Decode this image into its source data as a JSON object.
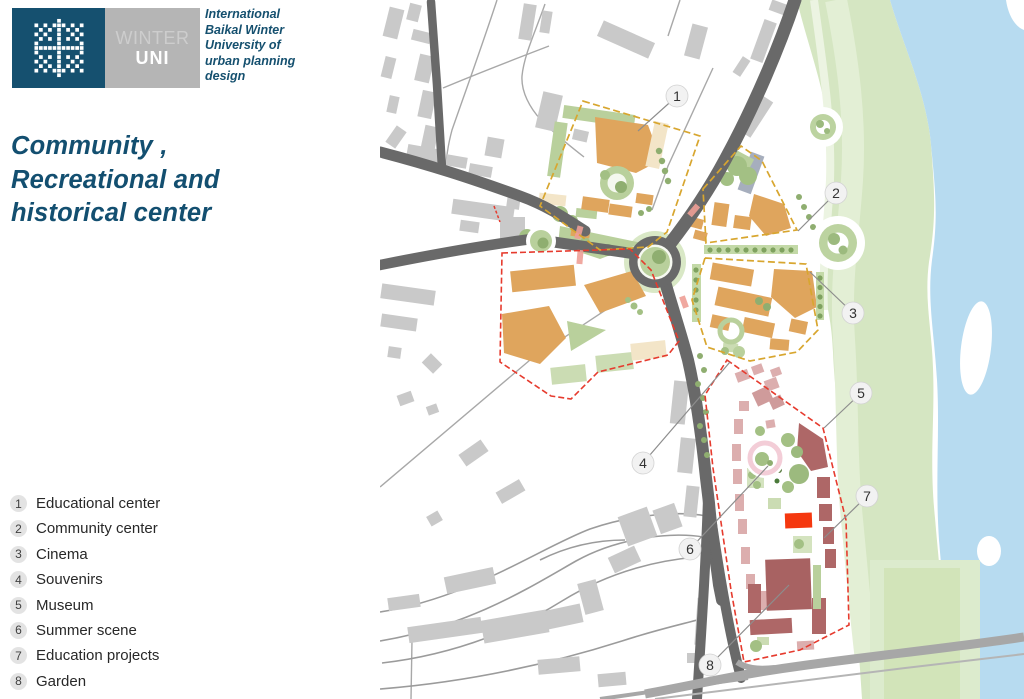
{
  "brand": {
    "winter": "WINTER",
    "uni": "UNI",
    "university_lines": [
      "International",
      "Baikal Winter",
      "University of",
      "urban planning",
      "design"
    ]
  },
  "title_lines": [
    "Community ,",
    "Recreational and",
    "historical center"
  ],
  "legend": [
    {
      "num": "1",
      "label": "Educational center"
    },
    {
      "num": "2",
      "label": "Community center"
    },
    {
      "num": "3",
      "label": "Cinema"
    },
    {
      "num": "4",
      "label": "Souvenirs"
    },
    {
      "num": "5",
      "label": "Museum"
    },
    {
      "num": "6",
      "label": "Summer scene"
    },
    {
      "num": "7",
      "label": "Education projects"
    },
    {
      "num": "8",
      "label": "Garden"
    }
  ],
  "map": {
    "callouts": [
      {
        "num": "1",
        "cx": 677,
        "cy": 96,
        "lx": 638,
        "ly": 131
      },
      {
        "num": "2",
        "cx": 836,
        "cy": 193,
        "lx": 798,
        "ly": 231
      },
      {
        "num": "3",
        "cx": 853,
        "cy": 313,
        "lx": 810,
        "ly": 272
      },
      {
        "num": "4",
        "cx": 643,
        "cy": 463,
        "lx": 730,
        "ly": 362
      },
      {
        "num": "5",
        "cx": 861,
        "cy": 393,
        "lx": 824,
        "ly": 428
      },
      {
        "num": "6",
        "cx": 690,
        "cy": 549,
        "lx": 768,
        "ly": 466
      },
      {
        "num": "7",
        "cx": 867,
        "cy": 496,
        "lx": 824,
        "ly": 538
      },
      {
        "num": "8",
        "cx": 710,
        "cy": 665,
        "lx": 789,
        "ly": 585
      }
    ]
  },
  "colors": {
    "accent_teal": "#15506f",
    "dash_yellow": "#d8a62f",
    "dash_red": "#e63b2e",
    "river_blue": "#b7dbf0",
    "building_orange": "#dfa55d",
    "building_rose": "#ae6767",
    "highlight_red": "#f5380f"
  }
}
